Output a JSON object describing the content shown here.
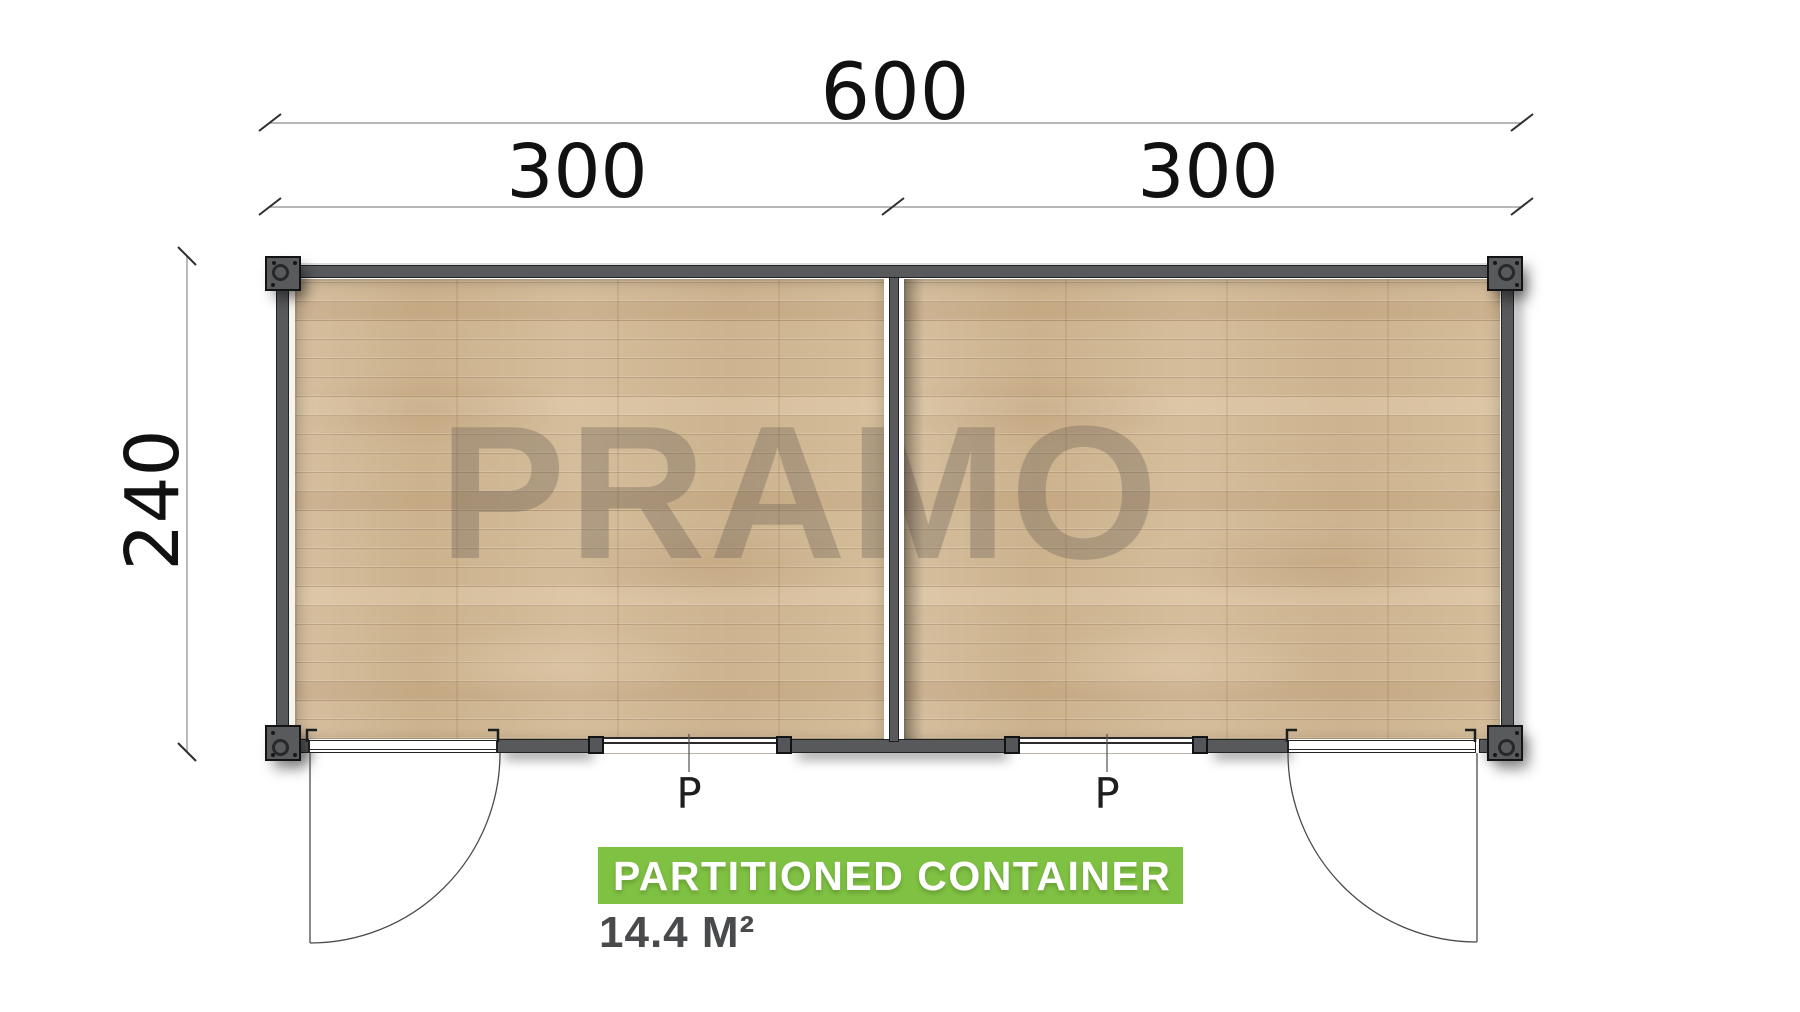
{
  "watermark": "PRAMO",
  "dimensions": {
    "total": "600",
    "left": "300",
    "right": "300",
    "side": "240"
  },
  "windows": {
    "left_label": "P",
    "right_label": "P"
  },
  "caption": {
    "title": "PARTITIONED CONTAINER",
    "area": "14.4 M²"
  },
  "colors": {
    "accent_green": "#7fc142",
    "wall_gray": "#58595b",
    "floor_wood": "#d2b996",
    "dim_text": "#111111",
    "area_text": "#494a4c"
  }
}
